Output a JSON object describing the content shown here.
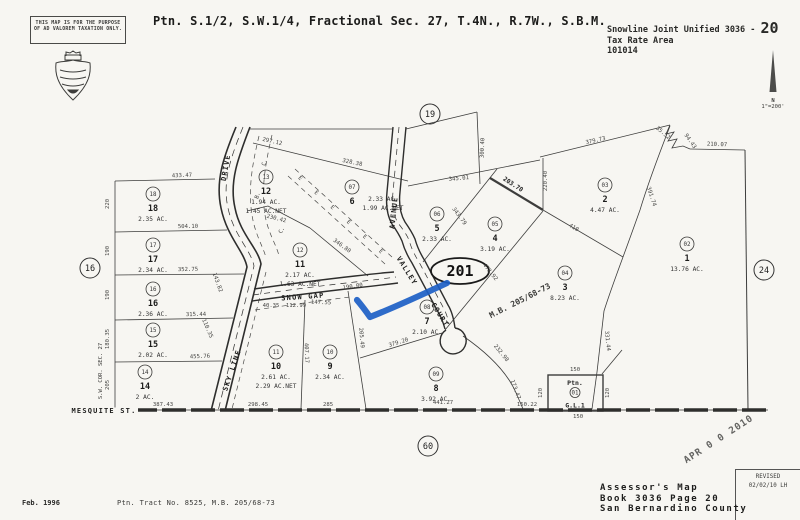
{
  "header": {
    "disclaimer_line1": "THIS MAP IS FOR THE PURPOSE",
    "disclaimer_line2": "OF AD VALOREM TAXATION ONLY.",
    "title": "Ptn. S.1/2, S.W.1/4, Fractional Sec. 27, T.4N., R.7W., S.B.M.",
    "district_line": "Snowline Joint Unified 3036 -",
    "page_large": "20",
    "tra_label": "Tax Rate Area",
    "tra_code": "101014",
    "north_label": "N",
    "scale": "1\"=200'"
  },
  "footer": {
    "date": "Feb. 1996",
    "tract_note": "Ptn. Tract No. 8525, M.B. 205/68-73",
    "stamp": "APR 0 0 2010",
    "revised_label": "REVISED",
    "revised_date": "02/02/10 LH",
    "assessor_line1": "Assessor's Map",
    "assessor_line2": "Book 3036 Page 20",
    "assessor_line3": "San Bernardino County"
  },
  "map": {
    "annotation": {
      "name": "blue-checkmark",
      "color": "#1c5ec6",
      "path": "M357,300 Q363,307 370,317 Q398,306 447,283"
    },
    "ref_ellipse": {
      "label": "201",
      "x": 460,
      "y": 271
    },
    "page_refs": [
      {
        "label": "19",
        "x": 430,
        "y": 114
      },
      {
        "label": "16",
        "x": 90,
        "y": 268
      },
      {
        "label": "24",
        "x": 764,
        "y": 270
      },
      {
        "label": "60",
        "x": 428,
        "y": 446
      }
    ],
    "parcels": [
      {
        "apn": "18",
        "circle": "18",
        "x": 153,
        "y": 194,
        "acres": [
          "2.35 AC."
        ]
      },
      {
        "apn": "17",
        "circle": "17",
        "x": 153,
        "y": 245,
        "acres": [
          "2.34 AC."
        ]
      },
      {
        "apn": "16",
        "circle": "16",
        "x": 153,
        "y": 289,
        "acres": [
          "2.36 AC."
        ]
      },
      {
        "apn": "15",
        "circle": "15",
        "x": 153,
        "y": 330,
        "acres": [
          "2.02 AC."
        ]
      },
      {
        "apn": "14",
        "circle": "14",
        "x": 145,
        "y": 372,
        "acres": [
          "2 AC."
        ]
      },
      {
        "apn": "12",
        "circle": "13",
        "x": 266,
        "y": 177,
        "acres": [
          "1.94 AC.",
          "1.45 AC.NET"
        ]
      },
      {
        "apn": "11",
        "circle": "12",
        "x": 300,
        "y": 250,
        "acres": [
          "2.17 AC.",
          "1.63 AC.NET"
        ]
      },
      {
        "apn": "10",
        "circle": "11",
        "x": 276,
        "y": 352,
        "acres": [
          "2.61 AC.",
          "2.29 AC.NET"
        ]
      },
      {
        "apn": "9",
        "circle": "10",
        "x": 330,
        "y": 352,
        "acres": [
          "2.34 AC."
        ]
      },
      {
        "apn": "8",
        "circle": "09",
        "x": 436,
        "y": 374,
        "acres": [
          "3.92 AC."
        ]
      },
      {
        "apn": "7",
        "circle": "08",
        "x": 427,
        "y": 307,
        "acres": [
          "2.10 AC."
        ]
      },
      {
        "apn": "6",
        "circle": "07",
        "x": 352,
        "y": 187,
        "acres": [
          "2.33 AC.",
          "1.99 AC.NET"
        ],
        "adx": 31,
        "ady": -13
      },
      {
        "apn": "5",
        "circle": "06",
        "x": 437,
        "y": 214,
        "acres": [
          "2.33 AC."
        ]
      },
      {
        "apn": "4",
        "circle": "05",
        "x": 495,
        "y": 224,
        "acres": [
          "3.19 AC."
        ]
      },
      {
        "apn": "3",
        "circle": "04",
        "x": 565,
        "y": 273,
        "acres": [
          "8.23 AC."
        ]
      },
      {
        "apn": "2",
        "circle": "03",
        "x": 605,
        "y": 185,
        "acres": [
          "4.47 AC."
        ]
      },
      {
        "apn": "1",
        "circle": "02",
        "x": 687,
        "y": 244,
        "acres": [
          "13.76 AC."
        ]
      }
    ],
    "dimensions": [
      {
        "t": "433.47",
        "x": 182,
        "y": 177,
        "r": -2
      },
      {
        "t": "504.10",
        "x": 188,
        "y": 228,
        "r": -1
      },
      {
        "t": "352.75",
        "x": 188,
        "y": 271,
        "r": -1
      },
      {
        "t": "315.44",
        "x": 196,
        "y": 316,
        "r": -1
      },
      {
        "t": "455.76",
        "x": 200,
        "y": 358,
        "r": -2
      },
      {
        "t": "387.43",
        "x": 163,
        "y": 406,
        "r": 0
      },
      {
        "t": "298.45",
        "x": 258,
        "y": 406,
        "r": 0
      },
      {
        "t": "285",
        "x": 328,
        "y": 406,
        "r": 0
      },
      {
        "t": "441.27",
        "x": 443,
        "y": 404,
        "r": 0
      },
      {
        "t": "150.22",
        "x": 527,
        "y": 406,
        "r": 0
      },
      {
        "t": "150",
        "x": 575,
        "y": 371,
        "r": 0
      },
      {
        "t": "150",
        "x": 578,
        "y": 418,
        "r": 0
      },
      {
        "t": "120",
        "x": 542,
        "y": 393,
        "r": -90
      },
      {
        "t": "120",
        "x": 609,
        "y": 393,
        "r": -90
      },
      {
        "t": "220",
        "x": 109,
        "y": 204,
        "r": -90
      },
      {
        "t": "190",
        "x": 109,
        "y": 251,
        "r": -90
      },
      {
        "t": "190",
        "x": 109,
        "y": 295,
        "r": -90
      },
      {
        "t": "180.35",
        "x": 109,
        "y": 339,
        "r": -90
      },
      {
        "t": "205",
        "x": 109,
        "y": 385,
        "r": -90
      },
      {
        "t": "297.12",
        "x": 272,
        "y": 143,
        "r": 13
      },
      {
        "t": "328.38",
        "x": 352,
        "y": 164,
        "r": 12
      },
      {
        "t": "346.80",
        "x": 341,
        "y": 247,
        "r": 36
      },
      {
        "t": "345.01",
        "x": 459,
        "y": 180,
        "r": -5
      },
      {
        "t": "300.40",
        "x": 484,
        "y": 148,
        "r": -88
      },
      {
        "t": "203.70",
        "x": 512,
        "y": 186,
        "r": 33,
        "b": 1
      },
      {
        "t": "220.40",
        "x": 547,
        "y": 181,
        "r": -90
      },
      {
        "t": "379.73",
        "x": 596,
        "y": 142,
        "r": -13
      },
      {
        "t": "35.52",
        "x": 662,
        "y": 134,
        "r": 40
      },
      {
        "t": "94.43",
        "x": 689,
        "y": 142,
        "r": 55
      },
      {
        "t": "210.07",
        "x": 717,
        "y": 146,
        "r": 2
      },
      {
        "t": "391.74",
        "x": 650,
        "y": 197,
        "r": 72
      },
      {
        "t": "410",
        "x": 573,
        "y": 229,
        "r": 31
      },
      {
        "t": "343.79",
        "x": 458,
        "y": 217,
        "r": 54
      },
      {
        "t": "472.92",
        "x": 489,
        "y": 273,
        "r": 51
      },
      {
        "t": "331.44",
        "x": 606,
        "y": 341,
        "r": 84
      },
      {
        "t": "232.98",
        "x": 500,
        "y": 354,
        "r": 51
      },
      {
        "t": "173.47",
        "x": 514,
        "y": 390,
        "r": 70
      },
      {
        "t": "379.20",
        "x": 399,
        "y": 344,
        "r": -17
      },
      {
        "t": "205.49",
        "x": 360,
        "y": 338,
        "r": 85
      },
      {
        "t": "407.17",
        "x": 305,
        "y": 353,
        "r": 88
      },
      {
        "t": "190.00",
        "x": 353,
        "y": 288,
        "r": -9
      },
      {
        "t": "147.55",
        "x": 321,
        "y": 304,
        "r": 2
      },
      {
        "t": "40.35",
        "x": 271,
        "y": 307,
        "r": 0
      },
      {
        "t": "112.99",
        "x": 296,
        "y": 307,
        "r": 0
      },
      {
        "t": "143.82",
        "x": 216,
        "y": 283,
        "r": 70
      },
      {
        "t": "110.35",
        "x": 206,
        "y": 329,
        "r": 67
      },
      {
        "t": "230.42",
        "x": 276,
        "y": 220,
        "r": 14
      }
    ],
    "roads": [
      {
        "name": "DRIVE",
        "x": 228,
        "y": 168,
        "r": -80
      },
      {
        "name": "SKY LINE",
        "x": 234,
        "y": 371,
        "r": -71
      },
      {
        "name": "SNOW GAP",
        "x": 303,
        "y": 299,
        "r": -4
      },
      {
        "name": "AVENUE",
        "x": 396,
        "y": 213,
        "r": -84
      },
      {
        "name": "VALLEY",
        "x": 405,
        "y": 272,
        "r": 58
      },
      {
        "name": "COURT",
        "x": 438,
        "y": 316,
        "r": 58
      },
      {
        "name": "MESQUITE ST.",
        "x": 104,
        "y": 413,
        "r": 0,
        "bg": true
      }
    ],
    "misc_labels": [
      {
        "t": "M.B. 205/68-73",
        "x": 521,
        "y": 303,
        "r": -27,
        "size": 8,
        "b": 1
      },
      {
        "t": "S.W. COR. SEC. 27",
        "x": 102,
        "y": 371,
        "r": -90,
        "size": 5.5
      },
      {
        "t": "C.",
        "x": 266,
        "y": 163,
        "r": -72,
        "size": 5.5
      },
      {
        "t": "B.",
        "x": 259,
        "y": 196,
        "r": -72,
        "size": 5.5
      },
      {
        "t": "C.",
        "x": 283,
        "y": 231,
        "r": -62,
        "size": 5.5
      }
    ],
    "easement": {
      "symbol": "E",
      "x1": 291,
      "y1": 172,
      "x2": 388,
      "y2": 260,
      "count": 6,
      "angle": 42
    },
    "gl_box": {
      "line1": "Ptn.",
      "circle": "01",
      "line2": "G.L.1"
    }
  }
}
